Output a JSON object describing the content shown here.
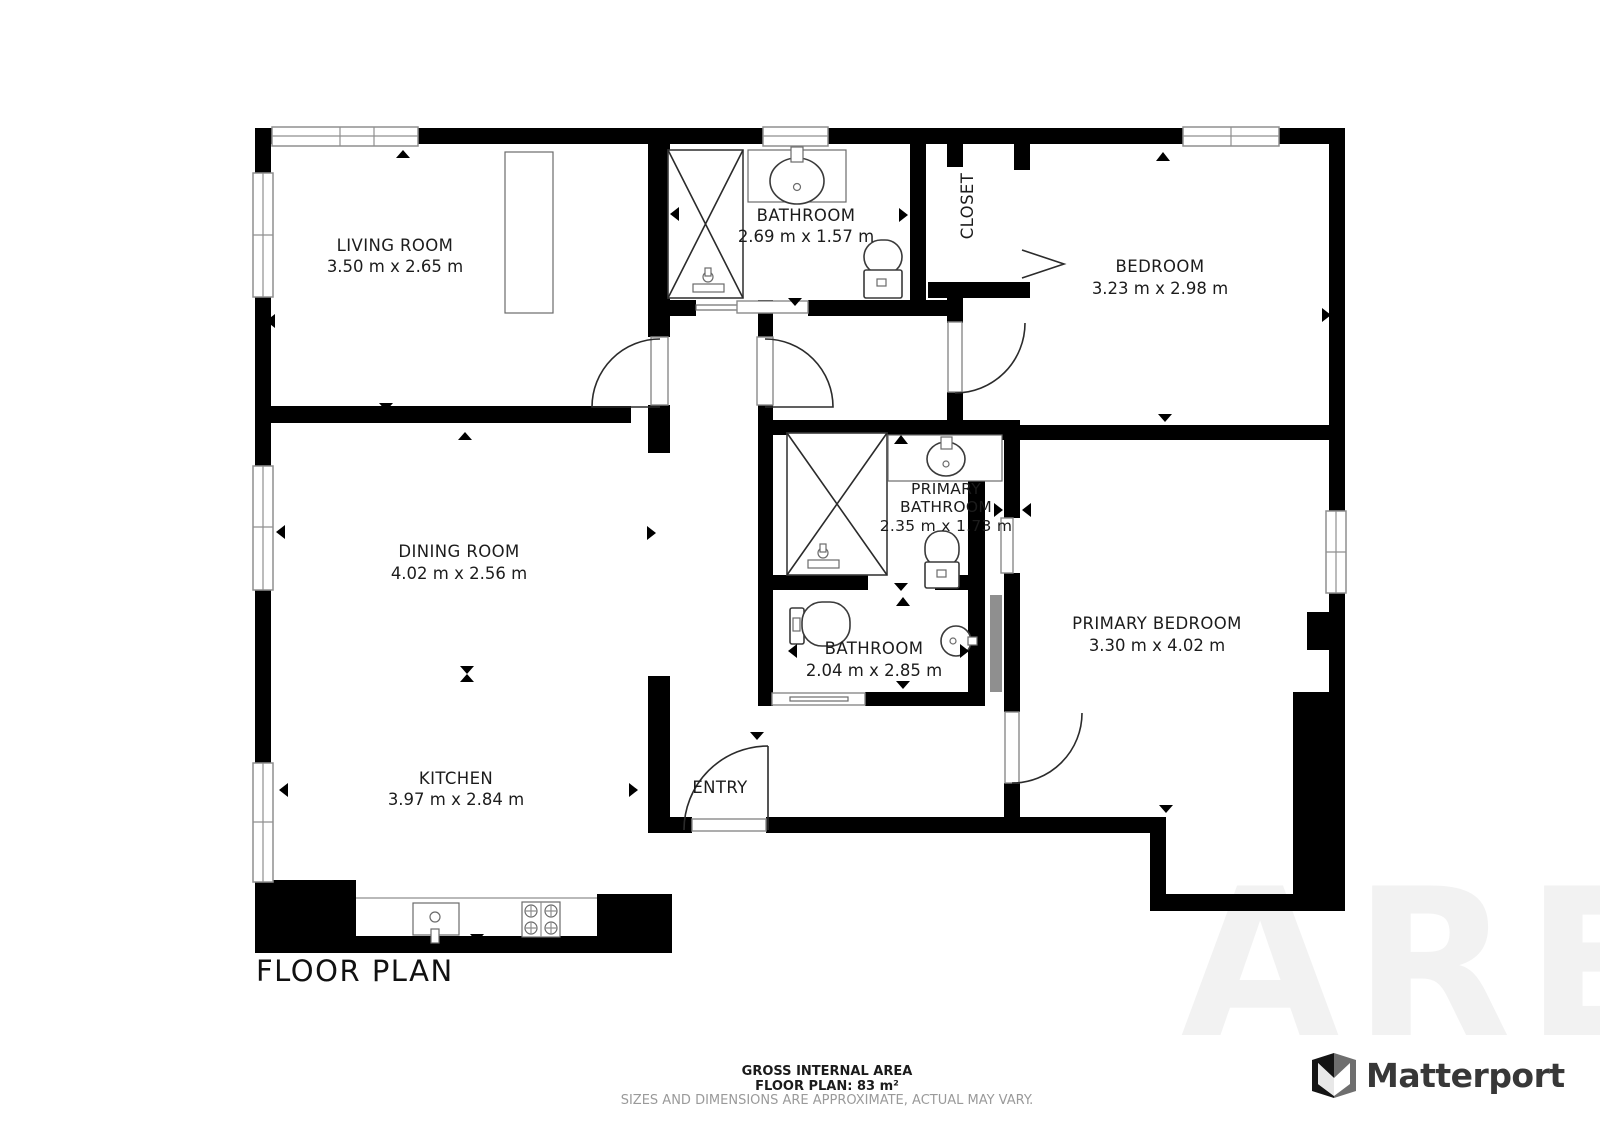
{
  "title": "FLOOR PLAN",
  "rooms": {
    "living_room": {
      "name": "LIVING ROOM",
      "dims": "3.50 m x 2.65 m"
    },
    "bathroom_top": {
      "name": "BATHROOM",
      "dims": "2.69 m x 1.57 m"
    },
    "closet": {
      "name": "CLOSET"
    },
    "bedroom": {
      "name": "BEDROOM",
      "dims": "3.23 m x 2.98 m"
    },
    "dining_room": {
      "name": "DINING ROOM",
      "dims": "4.02 m x 2.56 m"
    },
    "primary_bathroom": {
      "name_line1": "PRIMARY",
      "name_line2": "BATHROOM",
      "dims": "2.35 m x 1.73 m"
    },
    "bathroom_lower": {
      "name": "BATHROOM",
      "dims": "2.04 m x 2.85 m"
    },
    "primary_bedroom": {
      "name": "PRIMARY BEDROOM",
      "dims": "3.30 m x 4.02 m"
    },
    "kitchen": {
      "name": "KITCHEN",
      "dims": "3.97 m x 2.84 m"
    },
    "entry": {
      "name": "ENTRY"
    }
  },
  "footer": {
    "line1": "GROSS INTERNAL AREA",
    "line2": "FLOOR PLAN: 83 m²",
    "line3": "SIZES AND DIMENSIONS ARE APPROXIMATE, ACTUAL MAY VARY."
  },
  "brand": {
    "name": "Matterport"
  },
  "watermark": {
    "text": "ARE"
  },
  "colors": {
    "wall": "#000000",
    "window_stroke": "#8f8f8f",
    "muted": "#9a9a9a",
    "brand_text": "#383838"
  }
}
